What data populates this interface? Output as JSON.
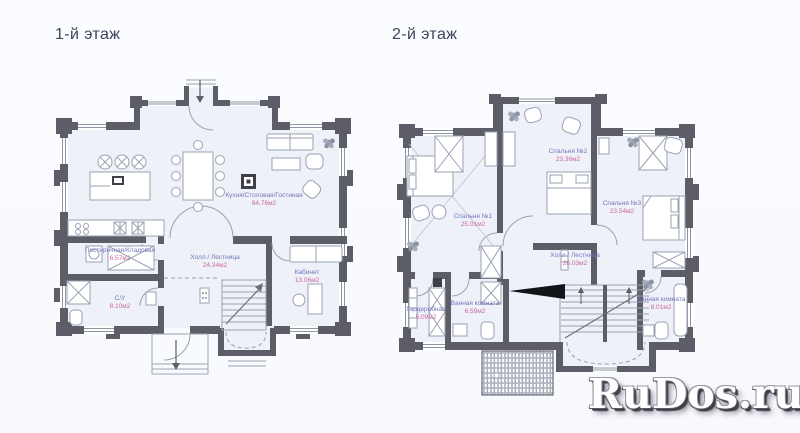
{
  "page": {
    "background": "#fafbfe"
  },
  "floors": [
    {
      "id": "floor-1",
      "title": "1-й этаж",
      "rooms": [
        {
          "name": "Кухня/Столовая/Гостиная",
          "area": "64.76м2"
        },
        {
          "name": "Постирочная/Кладовая",
          "area": "6.57м2"
        },
        {
          "name": "Холл / Лестница",
          "area": "24.34м2"
        },
        {
          "name": "Кабинет",
          "area": "13.06м2"
        },
        {
          "name": "С/У",
          "area": "8.10м2"
        }
      ]
    },
    {
      "id": "floor-2",
      "title": "2-й этаж",
      "rooms": [
        {
          "name": "Спальня №1",
          "area": "25.01м2"
        },
        {
          "name": "Спальня №2",
          "area": "23.36м2"
        },
        {
          "name": "Спальня №3",
          "area": "23.54м2"
        },
        {
          "name": "Холл / Лестница",
          "area": "26.03м2"
        },
        {
          "name": "Ванная комната",
          "area": "6.59м2"
        },
        {
          "name": "Гардеробная",
          "area": "5.09м2"
        },
        {
          "name": "Ванная комната",
          "area": "8.01м2"
        }
      ]
    }
  ],
  "watermark": {
    "text": "RuDos.ru"
  },
  "colors": {
    "wall": "#5c5d66",
    "floor_fill": "#eef1f8",
    "room_name_text": "#7276bb",
    "room_area_text": "#c9669f",
    "title_text": "#3d4459",
    "watermark_text": "#ffffff",
    "watermark_shadow": "#3f3f47"
  }
}
